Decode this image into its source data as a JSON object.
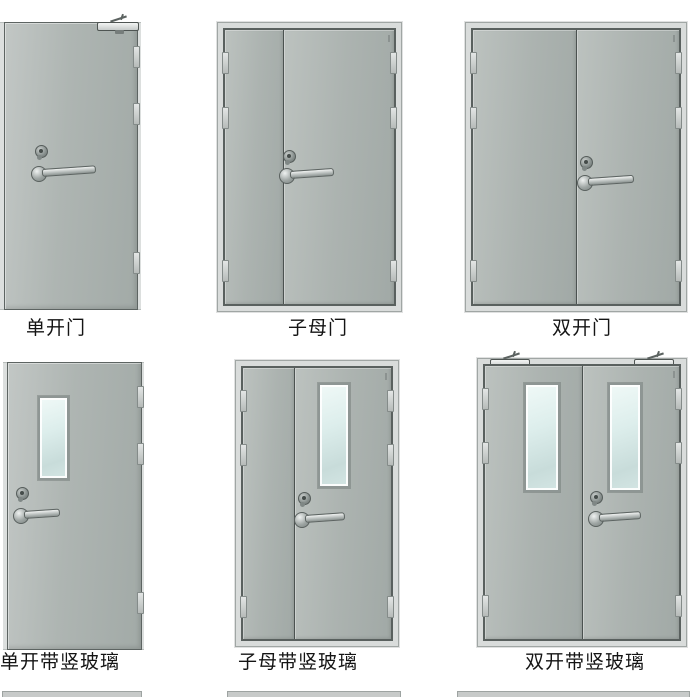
{
  "figure": {
    "kind": "fire-door-type-catalog",
    "background": "#ffffff",
    "door_face_color": "#aab1ae",
    "frame_color": "#d9dcdb",
    "glass_color": "#d9eae8",
    "caption_color": "#141414"
  },
  "doors": [
    {
      "label": "单开门",
      "type": "single-leaf"
    },
    {
      "label": "子母门",
      "type": "mother-child"
    },
    {
      "label": "双开门",
      "type": "double-leaf"
    },
    {
      "label": "单开带竖玻璃",
      "type": "single-leaf-vertical-glass"
    },
    {
      "label": "子母带竖玻璃",
      "type": "mother-child-vertical-glass"
    },
    {
      "label": "双开带竖玻璃",
      "type": "double-leaf-vertical-glass"
    }
  ]
}
